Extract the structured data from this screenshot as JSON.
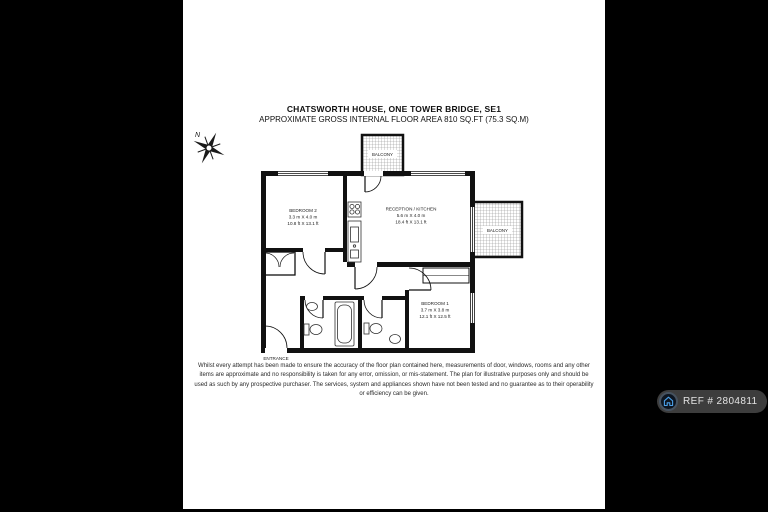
{
  "header": {
    "title": "CHATSWORTH HOUSE, ONE TOWER BRIDGE, SE1",
    "subtitle": "APPROXIMATE GROSS INTERNAL FLOOR AREA 810 SQ.FT (75.3 SQ.M)"
  },
  "compass": {
    "north_label": "N"
  },
  "plan": {
    "rooms": {
      "bedroom2": {
        "name": "BEDROOM 2",
        "metric": "3.3 m X 4.0 m",
        "imperial": "10.8 ft X 13.1 ft"
      },
      "reception": {
        "name": "RECEPTION / KITCHEN",
        "metric": "5.6 m X 4.0 m",
        "imperial": "18.4 ft X 13.1 ft"
      },
      "bedroom1": {
        "name": "BEDROOM 1",
        "metric": "3.7 m X 3.8 m",
        "imperial": "12.1 ft X 12.5 ft"
      },
      "balcony_top": {
        "name": "BALCONY"
      },
      "balcony_right": {
        "name": "BALCONY"
      },
      "entrance": {
        "name": "ENTRANCE"
      }
    }
  },
  "disclaimer": "Whilst every attempt has been made to ensure the accuracy of the floor plan contained here, measurements of door, windows, rooms and any other items are approximate and no responsibility is taken for any error, omission, or mis-statement. The plan for illustrative purposes only and should be used as such by any prospective purchaser. The services, system and appliances shown have not been tested and no guarantee as to their operability or efficiency can be given.",
  "ref_badge": {
    "label": "REF # 2804811"
  },
  "colors": {
    "background": "#000000",
    "paper": "#ffffff",
    "wall": "#111111",
    "hatch": "#909090",
    "badge_pill": "#3d3d3d",
    "badge_house": "#4ba0e8"
  }
}
